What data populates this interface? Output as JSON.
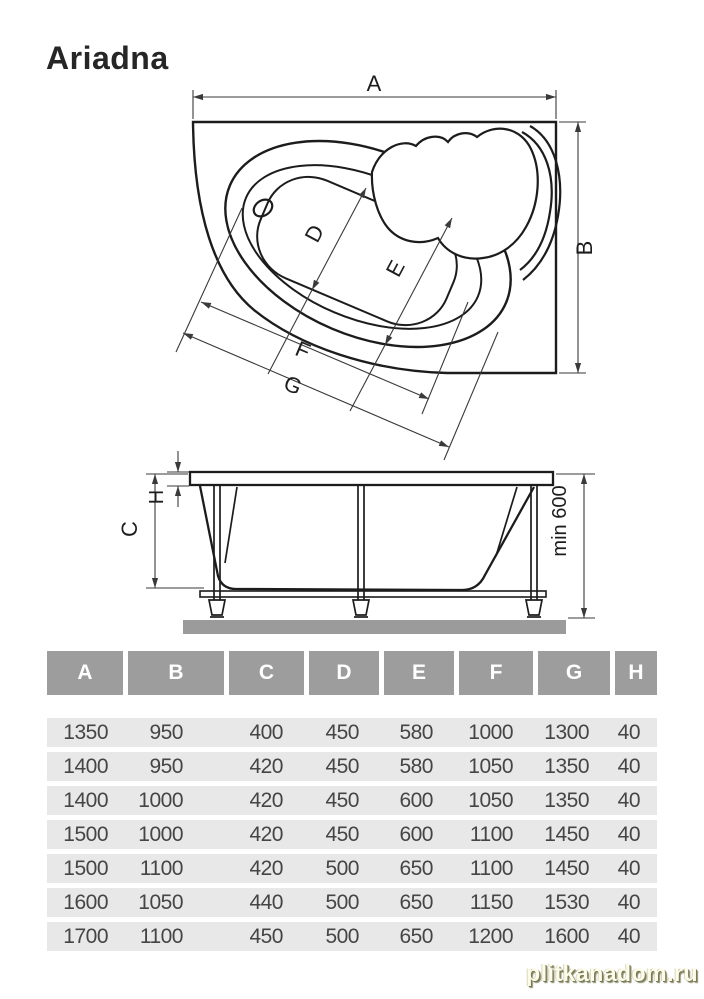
{
  "title": "Ariadna",
  "top_view": {
    "dim_a": "A",
    "dim_b": "B",
    "dim_d": "D",
    "dim_e": "E",
    "dim_f": "F",
    "dim_g": "G"
  },
  "side_view": {
    "dim_c": "C",
    "dim_h": "H",
    "dim_min": "min 600"
  },
  "table": {
    "headers": [
      "A",
      "B",
      "C",
      "D",
      "E",
      "F",
      "G",
      "H"
    ],
    "rows": [
      [
        "1350",
        "950",
        "400",
        "450",
        "580",
        "1000",
        "1300",
        "40"
      ],
      [
        "1400",
        "950",
        "420",
        "450",
        "580",
        "1050",
        "1350",
        "40"
      ],
      [
        "1400",
        "1000",
        "420",
        "450",
        "600",
        "1050",
        "1350",
        "40"
      ],
      [
        "1500",
        "1000",
        "420",
        "450",
        "600",
        "1100",
        "1450",
        "40"
      ],
      [
        "1500",
        "1100",
        "420",
        "500",
        "650",
        "1100",
        "1450",
        "40"
      ],
      [
        "1600",
        "1050",
        "440",
        "500",
        "650",
        "1150",
        "1530",
        "40"
      ],
      [
        "1700",
        "1100",
        "450",
        "500",
        "650",
        "1200",
        "1600",
        "40"
      ]
    ]
  },
  "watermark": "plitkanadom.ru",
  "colors": {
    "header_bg": "#9d9d9d",
    "row_bg": "#e8e8e8",
    "line": "#1c1c1c",
    "dim": "#3a3a3a",
    "ground": "#9b9b9b"
  }
}
